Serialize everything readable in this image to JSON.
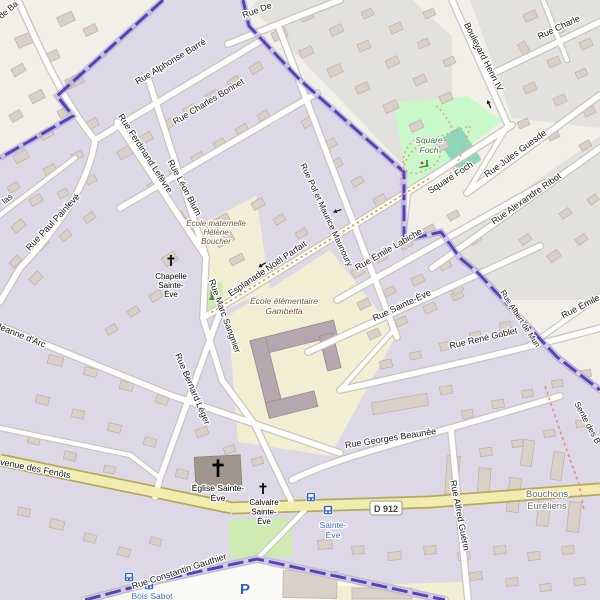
{
  "map": {
    "style": "openstreetmap-carto",
    "badge": {
      "text": "D 912",
      "x": 386,
      "y": 511
    },
    "colors": {
      "inside_boundary_residential": "#dcd8e6",
      "outside_bg": "#f2efe8",
      "outside_bottom": "#f7f5ef",
      "outside_residential": "#e3e1dd",
      "parking_area": "#fbfaf7",
      "road": "#ffffff",
      "road_casing": "#c9c5bc",
      "secondary_road": "#f2ecae",
      "secondary_casing": "#b5a95e",
      "boundary": "#4b38b4",
      "boundary_halo": "#a39ad8",
      "park": "#c9f8cb",
      "grass": "#cdebb0",
      "pitch": "#8fd7bb",
      "school": "#f1eed3",
      "building": "#d9d1c9",
      "bus_blue": "#3668c9",
      "path_dash": "#ef8a8a",
      "esplanade_dash": "#e8a13c"
    },
    "street_labels": [
      {
        "text": "Rue Alphonse Barré",
        "x": 172,
        "y": 64,
        "r": -31,
        "size": 9
      },
      {
        "text": "Rue Charles Bonnet",
        "x": 210,
        "y": 104,
        "r": -31,
        "size": 9
      },
      {
        "text": "Rue Ferdinand Lefèvre",
        "x": 143,
        "y": 155,
        "r": 57,
        "size": 9
      },
      {
        "text": "Rue Léon Blum",
        "x": 182,
        "y": 189,
        "r": 62,
        "size": 9
      },
      {
        "text": "Rue Paul Painlevé",
        "x": 55,
        "y": 224,
        "r": -47,
        "size": 9
      },
      {
        "text": "de Ba",
        "x": 10,
        "y": 12,
        "r": -40,
        "size": 8.5
      },
      {
        "text": "las",
        "x": 9,
        "y": 201,
        "r": -38,
        "size": 8.5
      },
      {
        "text": "Rue De",
        "x": 258,
        "y": 13,
        "r": -20,
        "size": 9
      },
      {
        "text": "Boulevard Henri IV",
        "x": 481,
        "y": 58,
        "r": 63,
        "size": 9
      },
      {
        "text": "Rue Charle",
        "x": 560,
        "y": 30,
        "r": -25,
        "size": 9
      },
      {
        "text": "Rue Jules Guesde",
        "x": 517,
        "y": 156,
        "r": -36,
        "size": 9
      },
      {
        "text": "Rue Alexandre Ribot",
        "x": 528,
        "y": 201,
        "r": -35,
        "size": 9
      },
      {
        "text": "Square Foch",
        "x": 452,
        "y": 180,
        "r": -33,
        "size": 9
      },
      {
        "text": "Rue Pol et Maurice Maunoury",
        "x": 324,
        "y": 216,
        "r": 65,
        "size": 8.5
      },
      {
        "text": "Esplanade Noël Parfait",
        "x": 269,
        "y": 271,
        "r": -34,
        "size": 9
      },
      {
        "text": "Rue Marc Sangnier",
        "x": 222,
        "y": 317,
        "r": 70,
        "size": 9
      },
      {
        "text": "Rue Émile Labiche",
        "x": 390,
        "y": 252,
        "r": -30,
        "size": 9
      },
      {
        "text": "Rue Sainte-Ève",
        "x": 403,
        "y": 308,
        "r": -25,
        "size": 9
      },
      {
        "text": "Rue René Goblet",
        "x": 484,
        "y": 341,
        "r": -13,
        "size": 9
      },
      {
        "text": "Rue Bernard Léger",
        "x": 190,
        "y": 390,
        "r": 67,
        "size": 9
      },
      {
        "text": "Jeanne d'Arc",
        "x": 20,
        "y": 338,
        "r": 22,
        "size": 9
      },
      {
        "text": "Rue Georges Beaunée",
        "x": 391,
        "y": 441,
        "r": -9,
        "size": 9
      },
      {
        "text": "Rue Alfred Guérin",
        "x": 457,
        "y": 516,
        "r": 79,
        "size": 9
      },
      {
        "text": "Avenue des Fenôts",
        "x": 32,
        "y": 471,
        "r": 11,
        "size": 9
      },
      {
        "text": "Rue Constantin Gauthier",
        "x": 180,
        "y": 574,
        "r": -18,
        "size": 9
      },
      {
        "text": "Rue Émile G",
        "x": 586,
        "y": 307,
        "r": -27,
        "size": 9
      },
      {
        "text": "Rue Albert de Mun",
        "x": 518,
        "y": 320,
        "r": 57,
        "size": 8
      },
      {
        "text": "Sente des B",
        "x": 585,
        "y": 424,
        "r": 62,
        "size": 8.5
      }
    ],
    "place_labels": [
      {
        "name": "square-foch-park-label",
        "cls": "park",
        "size": 8.5,
        "x": 429,
        "y": 143,
        "lh": 10,
        "lines": [
          "Square",
          "Foch"
        ]
      },
      {
        "name": "ecole-maternelle-label",
        "cls": "school",
        "size": 8,
        "x": 216,
        "y": 226,
        "lh": 9,
        "lines": [
          "École maternelle",
          "Hélène",
          "Boucher"
        ]
      },
      {
        "name": "ecole-elementaire-label",
        "cls": "school",
        "size": 8.5,
        "x": 284,
        "y": 304,
        "lh": 10,
        "lines": [
          "École élémentaire",
          "Gambetta"
        ]
      },
      {
        "name": "chapelle-sainte-eve-label",
        "cls": "church",
        "size": 8,
        "x": 171,
        "y": 279,
        "lh": 9,
        "lines": [
          "Chapelle",
          "Sainte-",
          "Ève"
        ]
      },
      {
        "name": "eglise-sainte-eve-label",
        "cls": "church",
        "size": 8.5,
        "x": 218,
        "y": 491,
        "lh": 10,
        "lines": [
          "Église Sainte-",
          "Ève"
        ]
      },
      {
        "name": "calvaire-sainte-eve-label",
        "cls": "church",
        "size": 8,
        "x": 264,
        "y": 505,
        "lh": 9.5,
        "lines": [
          "Calvaire",
          "Sainte-",
          "Ève"
        ]
      },
      {
        "name": "bus-stop-sainte-eve-label",
        "cls": "bus",
        "size": 8.5,
        "x": 333,
        "y": 528,
        "lh": 10,
        "lines": [
          "Sainte-",
          "Ève"
        ]
      },
      {
        "name": "bus-stop-bois-sabot-label",
        "cls": "bus",
        "size": 8.5,
        "x": 152,
        "y": 599,
        "lh": 10,
        "lines": [
          "Bois Sabot"
        ]
      },
      {
        "name": "locality-bouchons-eureliens",
        "cls": "loc",
        "size": 9.5,
        "x": 547,
        "y": 497,
        "lh": 12,
        "lines": [
          "Bouchons",
          "Euréliens"
        ]
      },
      {
        "name": "parking-label",
        "cls": "pk",
        "size": 15,
        "x": 245,
        "y": 594,
        "lh": 10,
        "lines": [
          "P"
        ]
      }
    ],
    "icons": [
      {
        "type": "bus",
        "x": 311,
        "y": 497
      },
      {
        "type": "bus",
        "x": 328,
        "y": 510
      },
      {
        "type": "bus",
        "x": 129,
        "y": 577
      },
      {
        "type": "bus",
        "x": 149,
        "y": 585
      },
      {
        "type": "cross",
        "x": 171,
        "y": 261,
        "s": 1
      },
      {
        "type": "cross",
        "x": 218,
        "y": 469,
        "s": 1.6
      },
      {
        "type": "cross",
        "x": 263,
        "y": 489,
        "s": 1
      },
      {
        "type": "monument",
        "x": 212,
        "y": 295
      },
      {
        "type": "playground",
        "x": 424,
        "y": 164
      },
      {
        "type": "arrow",
        "x": 474,
        "y": 46,
        "r": 66
      },
      {
        "type": "arrow",
        "x": 489,
        "y": 104,
        "r": -114
      },
      {
        "type": "arrow",
        "x": 262,
        "y": 265,
        "r": 148
      },
      {
        "type": "arrow",
        "x": 337,
        "y": 211,
        "r": 162
      },
      {
        "type": "arrow",
        "x": 220,
        "y": 304,
        "r": -95
      }
    ]
  }
}
